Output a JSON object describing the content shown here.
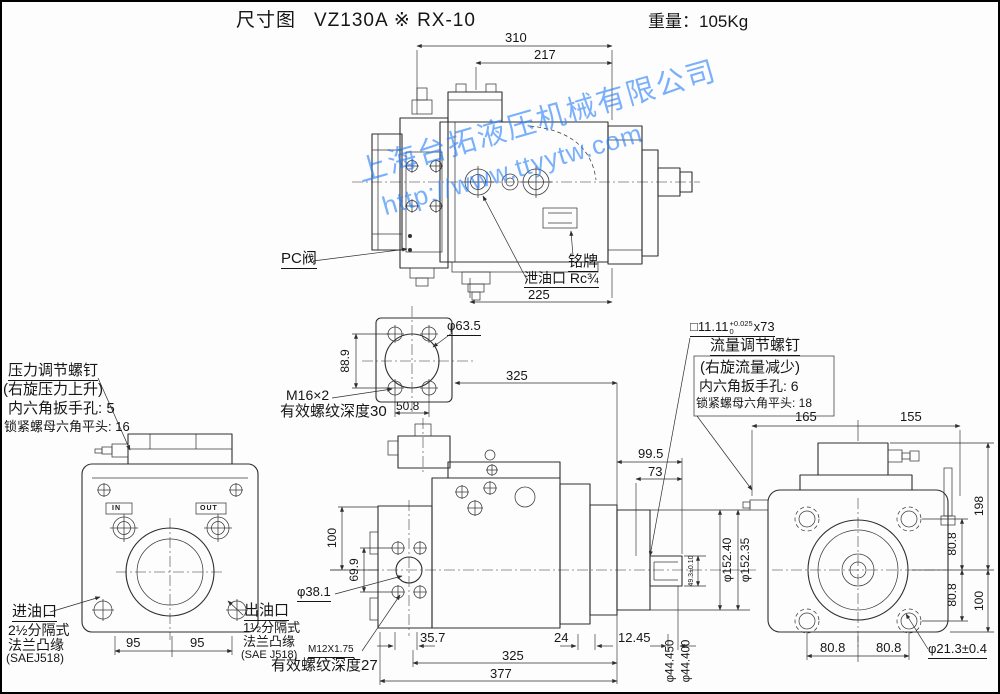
{
  "header": {
    "doc_type": "尺寸图",
    "model": "VZ130A ※ RX-10",
    "weight_label": "重量：105Kg"
  },
  "watermark": {
    "company": "上海台拓液压机械有限公司",
    "url": "http://www.ttyytw.com",
    "color": "#237dfa"
  },
  "top_view": {
    "dim_310": "310",
    "dim_217": "217",
    "dim_225": "225",
    "pc_valve": "PC阀",
    "nameplate": "铭牌",
    "drain_port": "泄油口 Rc¾"
  },
  "pressure_note": {
    "title": "压力调节螺钉",
    "line2": "(右旋压力上升)",
    "line3": "内六角扳手孔: 5",
    "line4": "锁紧螺母六角平头: 16"
  },
  "flow_note": {
    "key_prefix": "□11.11",
    "key_tol_upper": "+0.025",
    "key_tol_lower": "0",
    "key_suffix": "x73",
    "title": "流量调节螺钉",
    "line2": "(右旋流量减少)",
    "line3": "内六角扳手孔: 6",
    "line4": "锁紧螺母六角平头: 18"
  },
  "flange_detail": {
    "dim_889": "88.9",
    "dia_635": "φ63.5",
    "thread": "M16×2",
    "thread_depth": "有效螺纹深度30",
    "dim_508": "50.8",
    "dim_325": "325"
  },
  "front_view": {
    "port_in_mark": "IN",
    "port_out_mark": "OUT",
    "dim_95_left": "95",
    "dim_95_right": "95",
    "inlet_title": "进油口",
    "inlet_line2": "2½分隔式",
    "inlet_line3": "法兰凸缘",
    "inlet_line4": "(SAEJ518)",
    "outlet_title": "出油口",
    "outlet_line2": "1½分隔式",
    "outlet_line3": "法兰凸缘",
    "outlet_line4": "(SAE J518)",
    "thread": "M12X1.75",
    "thread_depth": "有效螺纹深度27"
  },
  "side_view": {
    "dim_100": "100",
    "dim_699": "69.9",
    "dia_381": "φ38.1",
    "dim_357": "35.7",
    "dim_24": "24",
    "dim_1245": "12.45",
    "dim_325": "325",
    "dim_377": "377",
    "dim_995": "99.5",
    "dim_73": "73",
    "dia_15240": "φ152.40",
    "dia_15235": "φ152.35",
    "key_height": "49.3±0.10",
    "dia_44450": "φ44.450",
    "dia_44400": "φ44.400"
  },
  "rear_view": {
    "dim_165": "165",
    "dim_155": "155",
    "dim_198": "198",
    "dim_808_top": "80.8",
    "dim_808_mid": "80.8",
    "dim_100": "100",
    "dim_808_bl": "80.8",
    "dim_808_br": "80.8",
    "dia_213": "φ21.3±0.4"
  }
}
